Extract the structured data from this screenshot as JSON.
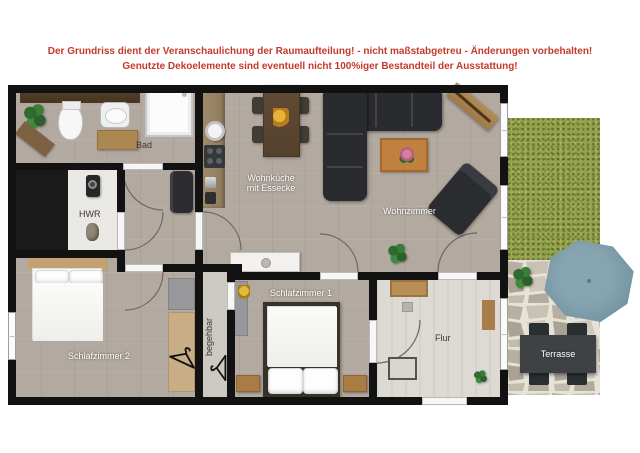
{
  "disclaimer": {
    "line1": "Der Grundriss dient der Veranschaulichung der Raumaufteilung! - nicht maßstabgetreu - Änderungen vorbehalten!",
    "line2": "Genutzte Dekoelemente sind eventuell nicht 100%iger Bestandteil der Ausstattung!"
  },
  "rooms": {
    "bad": "Bad",
    "hwr": "HWR",
    "wohnkueche_line1": "Wohnküche",
    "wohnkueche_line2": "mit Essecke",
    "wohnzimmer": "Wohnzimmer",
    "schlafzimmer1": "Schlafzimmer 1",
    "schlafzimmer2": "Schlafzimmer 2",
    "begehbar": "begehbar",
    "flur": "Flur",
    "terrasse": "Terrasse"
  },
  "colors": {
    "disclaimer_red": "#c43a2a",
    "wall_black": "#121212",
    "floor_taupe": "#b2a9a1",
    "floor_hwr": "#eae8e4",
    "floor_flur": "#dcdad3",
    "floor_begehbar": "#ccc9c2",
    "grass_green": "#96a24f",
    "stone_beige": "#d8d2c6",
    "parasol_teal": "#7b99a6",
    "sofa_charcoal": "#2a2b2f",
    "rug_orange": "#bf8040",
    "wood_counter": "#9b8366"
  }
}
